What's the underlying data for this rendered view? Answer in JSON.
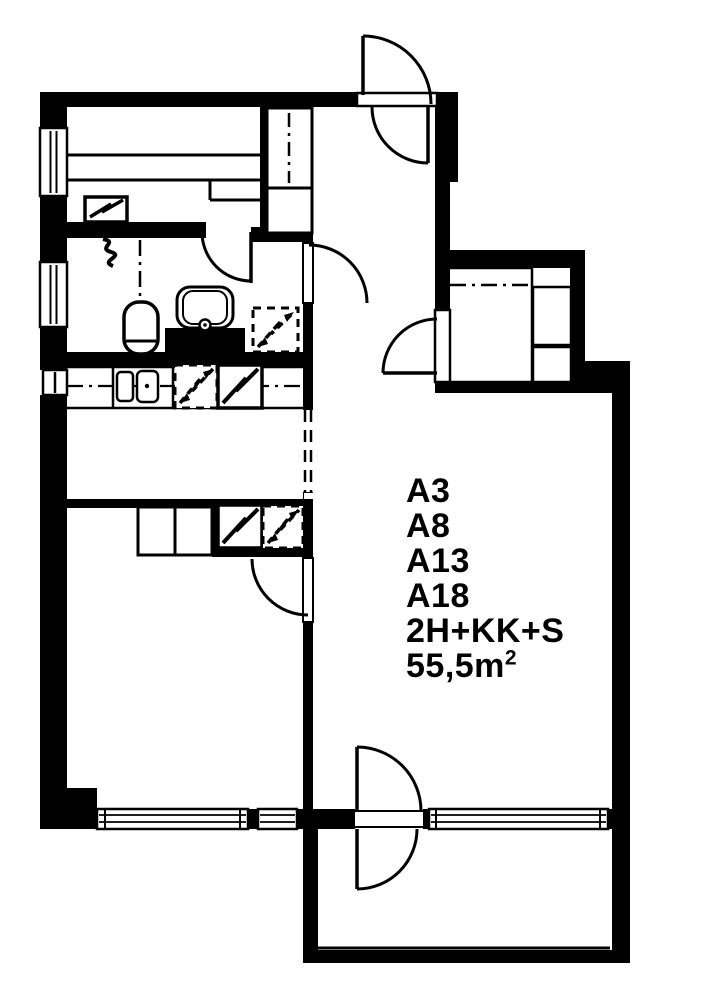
{
  "page": {
    "background_color": "#ffffff",
    "line_color": "#000000"
  },
  "plan": {
    "unit_labels": [
      "A3",
      "A8",
      "A13",
      "A18"
    ],
    "type_label": "2H+KK+S",
    "area_value": "55,5m",
    "area_superscript": "2"
  },
  "symbols": {
    "fixtures": [
      "sauna-benches",
      "sauna-stove",
      "hall-closet",
      "walk-in-closet-shelves",
      "toilet",
      "washbasin",
      "vanity-counter",
      "drain-squiggle",
      "washing-machine-reservation",
      "kitchen-sink",
      "dishwasher-reservation",
      "stove",
      "fridge",
      "appliance-reservation",
      "bedroom-wardrobe",
      "entrance-double-swing-door",
      "balcony-double-swing-door",
      "interior-door",
      "window",
      "balcony-glazing"
    ]
  }
}
